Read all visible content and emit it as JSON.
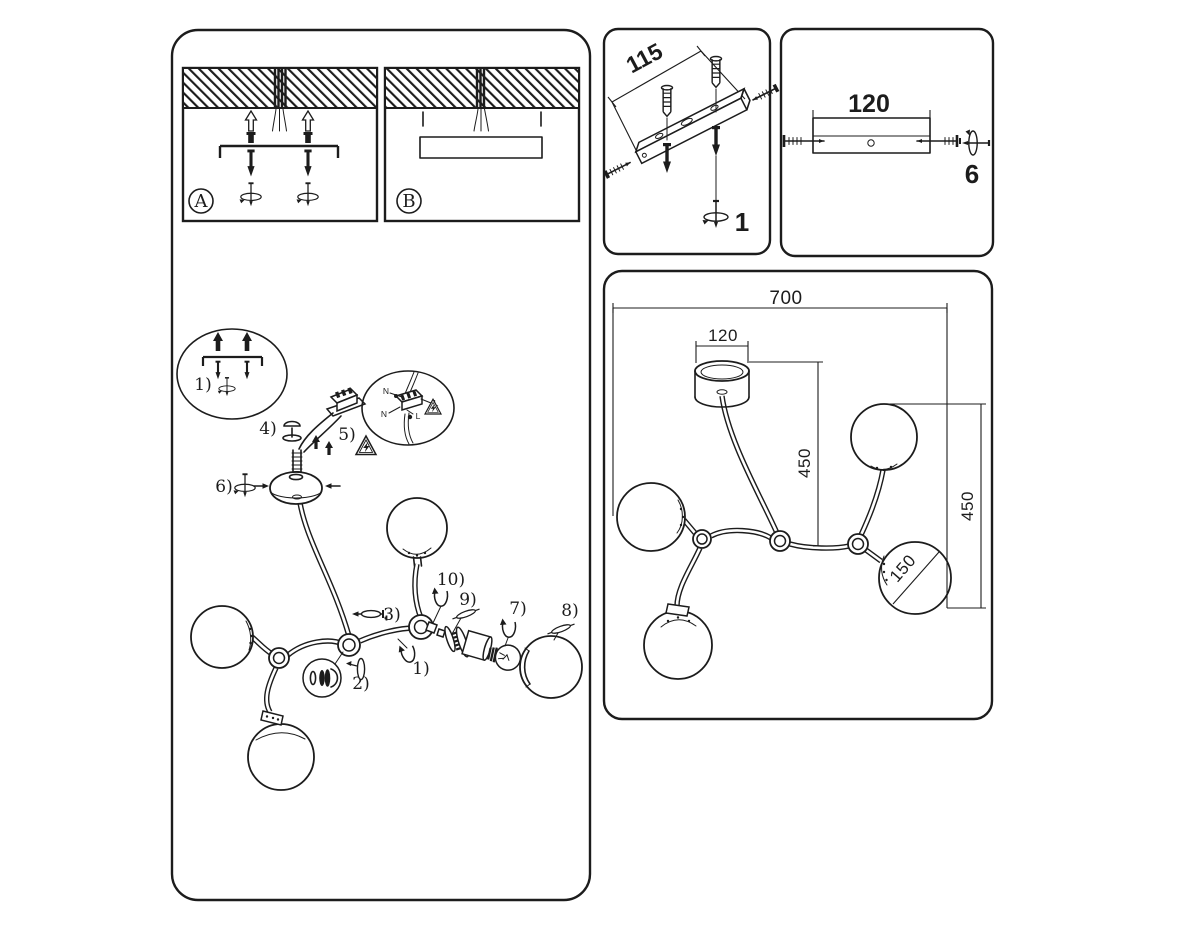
{
  "page": {
    "background": "#ffffff",
    "line_color": "#1c1c1c"
  },
  "mounting_options_panel": {
    "option_a_label": "A",
    "option_b_label": "B"
  },
  "bracket_install_panel": {
    "hole_spacing_dimension": "115",
    "step_number": "1"
  },
  "canopy_install_panel": {
    "bracket_length_dimension": "120",
    "step_number": "6"
  },
  "dimensions_panel": {
    "overall_width_mm": "700",
    "canopy_diameter_mm": "120",
    "center_drop_mm": "450",
    "side_drop_mm": "450",
    "globe_diameter_mm": "150"
  },
  "assembly_diagram": {
    "inset_step_label": "1)",
    "step_labels": {
      "s1": "1)",
      "s2": "2)",
      "s3": "3)",
      "s4": "4)",
      "s5": "5)",
      "s6": "6)",
      "s7": "7)",
      "s8": "8)",
      "s9": "9)",
      "s10": "10)"
    },
    "wiring_inset": {
      "neutral_top": "N",
      "live_top": "L",
      "neutral_bottom": "N",
      "live_bottom": "L"
    }
  }
}
